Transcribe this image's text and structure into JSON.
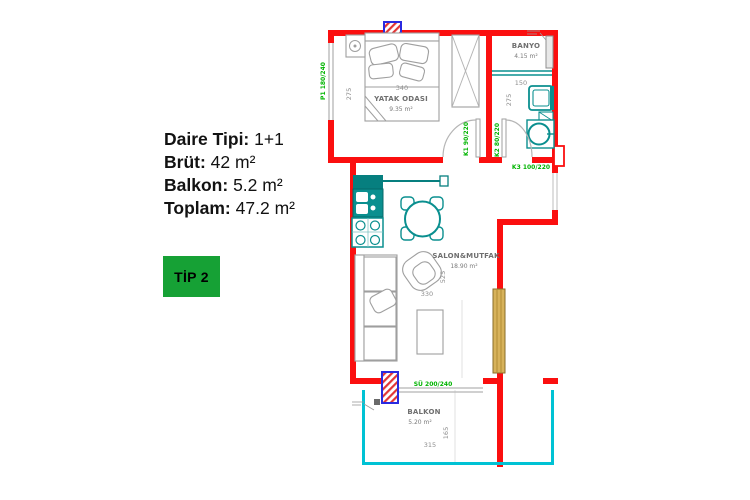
{
  "info": {
    "rows": [
      {
        "label": "Daire Tipi:",
        "value": "1+1"
      },
      {
        "label": "Brüt:",
        "value": "42 m²"
      },
      {
        "label": "Balkon:",
        "value": "5.2 m²"
      },
      {
        "label": "Toplam:",
        "value": "47.2 m²"
      }
    ],
    "type_badge": "TİP 2"
  },
  "plan": {
    "rooms": {
      "bedroom": {
        "name": "YATAK ODASI",
        "area": "9.35 m²",
        "width_cm": "340",
        "height_cm": "275"
      },
      "bathroom": {
        "name": "BANYO",
        "area": "4.15 m²",
        "width_cm": "150",
        "height_cm": "275"
      },
      "living": {
        "name": "SALON&MUTFAK",
        "area": "18.90 m²",
        "width_cm": "330",
        "height_cm": "525"
      },
      "balcony": {
        "name": "BALKON",
        "area": "5.20 m²",
        "width_cm": "315",
        "height_cm": "165"
      }
    },
    "openings": {
      "bedroom_window": "P1 180/240",
      "bedroom_door": "K1 90/220",
      "bathroom_door": "K2 80/220",
      "entrance_door": "K3 100/220",
      "balcony_slider": "SÜ 200/240"
    }
  },
  "colors": {
    "wall": "#fb0f0f",
    "balcony_line": "#00c2d4",
    "fixture": "#0a8f8f",
    "opening_label": "#00b400",
    "badge_bg": "#16a135",
    "badge_text": "#000000",
    "furniture": "#9f9f9f",
    "tan_panel": "#d7b25a",
    "hatch_fill": "#e23535",
    "hatch_border": "#2a2ae0"
  }
}
